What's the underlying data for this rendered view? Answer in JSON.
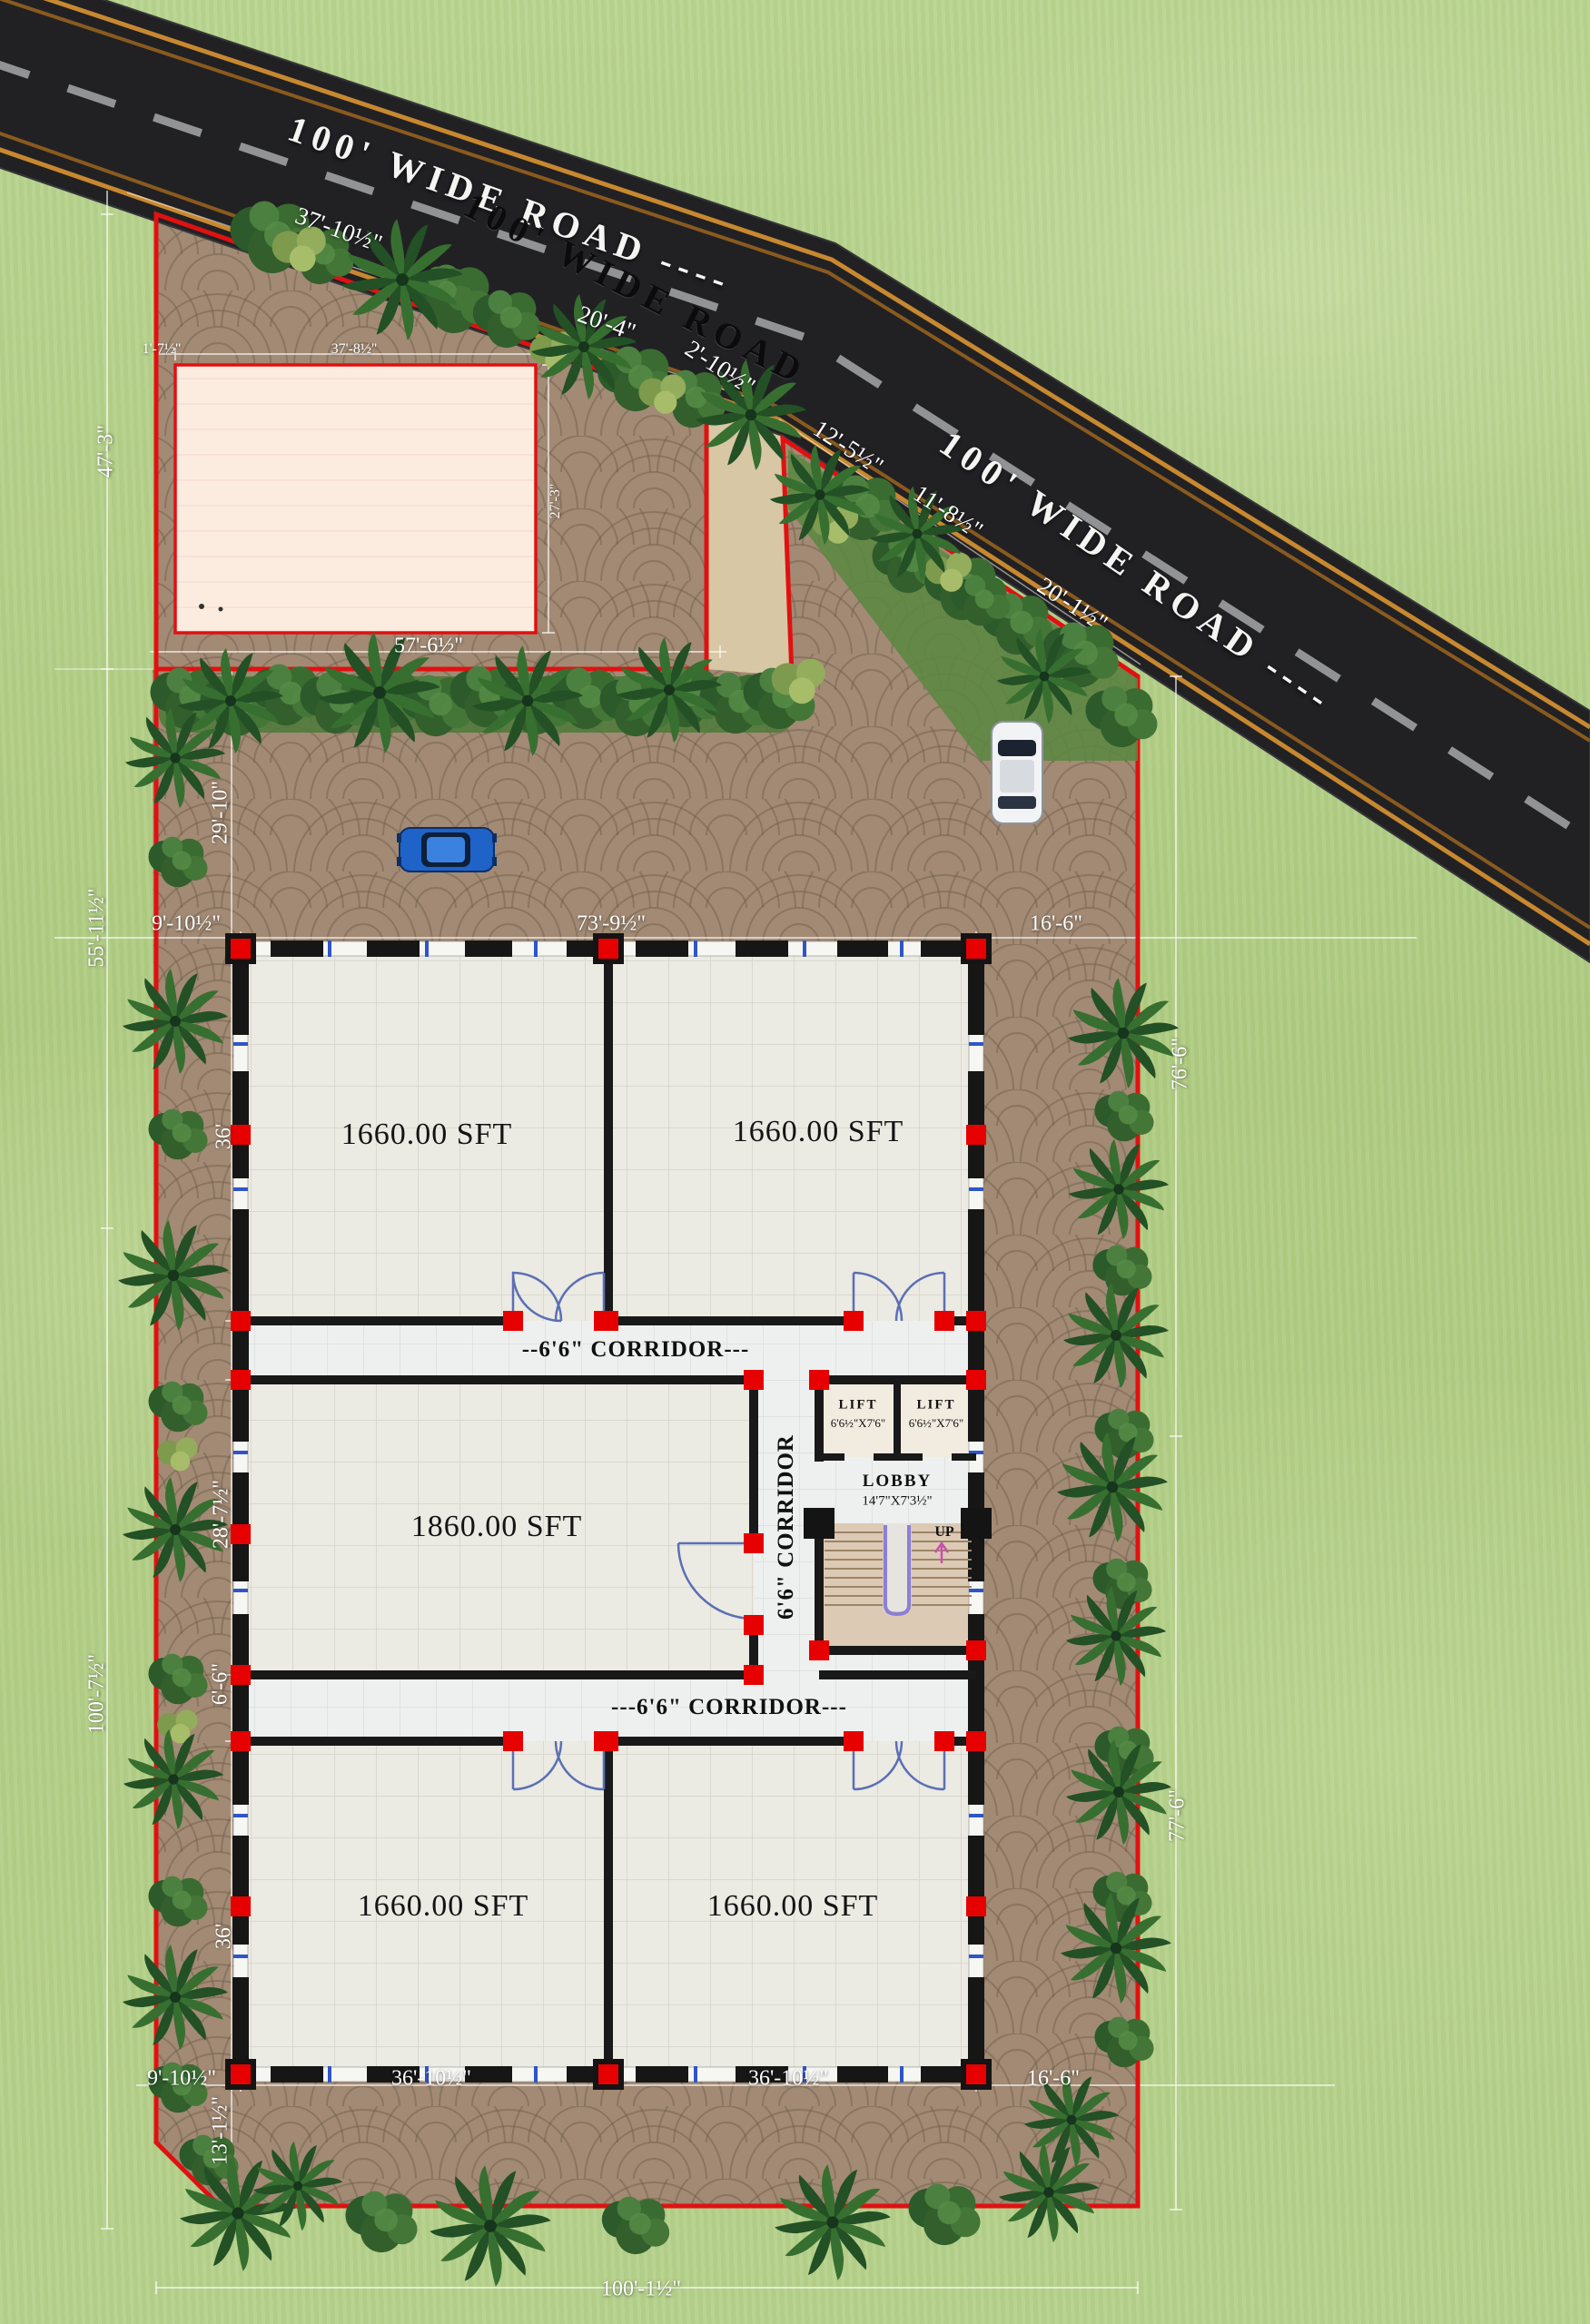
{
  "road": {
    "labels": [
      "100' WIDE ROAD ----",
      "100' WIDE ROAD",
      "100' WIDE ROAD ----"
    ],
    "dims": [
      "37'-10½\"",
      "20'-4\"",
      "2'-10½\"",
      "12'-5½\"",
      "11'-8½\"",
      "20'-1½\""
    ]
  },
  "site": {
    "dims": [
      "1'-7½\"",
      "37'-8½\"",
      "27'-3\"",
      "47'-3\"",
      "57'-6½\"",
      "29'-10\"",
      "55'-11½\"",
      "9'-10½\"",
      "73'-9½\"",
      "16'-6\"",
      "76'-6\"",
      "36'",
      "28'-7½\"",
      "6'-6\"",
      "100'-7½\"",
      "77'-6\"",
      "36'",
      "9'-10½\"",
      "36'-10½\"",
      "36'-10½\"",
      "16'-6\"",
      "13'-1½\"",
      "100'-1½\""
    ]
  },
  "building": {
    "rooms": [
      {
        "label": "1660.00 SFT"
      },
      {
        "label": "1660.00 SFT"
      },
      {
        "label": "1860.00 SFT"
      },
      {
        "label": "1660.00 SFT"
      },
      {
        "label": "1660.00 SFT"
      }
    ],
    "corridors": [
      "--6'6\" CORRIDOR---",
      "6'6\" CORRIDOR",
      "---6'6\" CORRIDOR---"
    ],
    "lifts": [
      {
        "name": "LIFT",
        "size": "6'6½\"X7'6\""
      },
      {
        "name": "LIFT",
        "size": "6'6½\"X7'6\""
      }
    ],
    "lobby": {
      "name": "LOBBY",
      "size": "14'7\"X7'3½\""
    },
    "stair_up": "UP"
  },
  "colors": {
    "boundary": "#e01111",
    "road_asphalt": "#212124",
    "road_edge_line": "#c8882f",
    "grass": "#b2cf86",
    "paver": "#a28a74",
    "pink_area": "#fcecdf",
    "wall": "#171717",
    "column": "#e60000",
    "window_tick": "#2f55c8"
  }
}
